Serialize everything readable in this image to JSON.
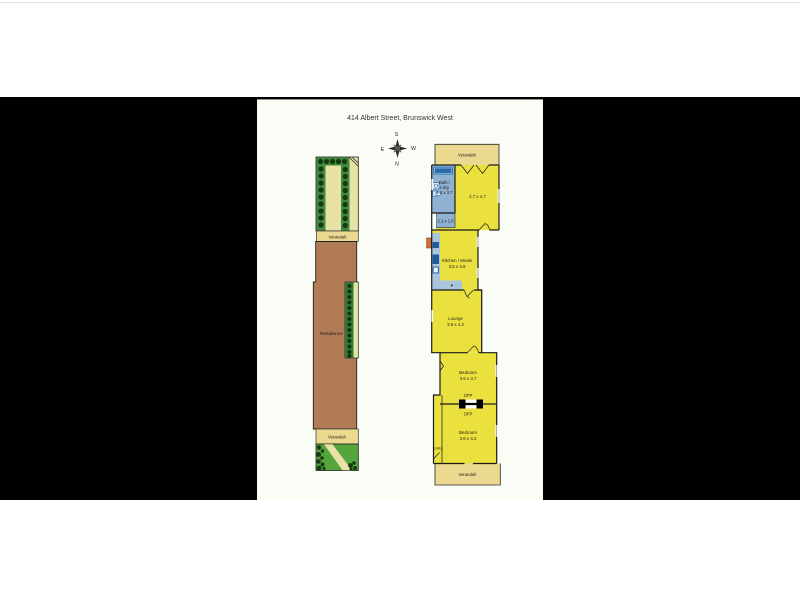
{
  "title": "414 Albert Street, Brunswick West",
  "compass": {
    "s": "S",
    "e": "E",
    "w": "W",
    "n": "N"
  },
  "site_plan": {
    "verandah_top": "Verandah",
    "residence": "Residence",
    "verandah_bottom": "Verandah"
  },
  "floor_plan": {
    "verandah_top": "Verandah",
    "bath_line1": "Bath /",
    "bath_line2": "L'dry",
    "bath_dims": "1.6 x 3.7",
    "hall_dims": "2.1 x 1.0",
    "rear_room_dims": "2.7 x 4.7",
    "kitchen_name": "Kitchen / Meals",
    "kitchen_dims": "3.5 x 4.9",
    "fridge_label": "F",
    "lounge_name": "Lounge",
    "lounge_dims": "3.5 x 4.2",
    "bedroom1_name": "Bedroom",
    "bedroom1_dims": "3.6 x 3.7",
    "ofp_label_top": "OFP",
    "ofp_label_bottom": "OFP",
    "bedroom2_name": "Bedroom",
    "bedroom2_dims": "3.6 x 4.3",
    "entry_label": "Entry",
    "verandah_bottom": "Verandah"
  },
  "colors": {
    "letterbox_black": "#000000",
    "content_bg": "#fafcf6",
    "room_yellow": "#ebe13e",
    "verandah_khaki": "#ead98f",
    "garden_inner_khaki": "#e9e2a6",
    "wet_area_blue": "#8fb2d2",
    "bench_blue": "#a9c4dd",
    "fixture_dark_blue": "#2d6cab",
    "appliance_blue": "#1f5c9e",
    "residence_brown": "#b17c55",
    "hedge_green": "#3f8a3d",
    "bed_green": "#2f7a33",
    "lawn_green": "#55a53e",
    "shrub_dark_green": "#153a10",
    "hws_orange": "#cf7036",
    "wall_black": "#1b1b1b"
  }
}
